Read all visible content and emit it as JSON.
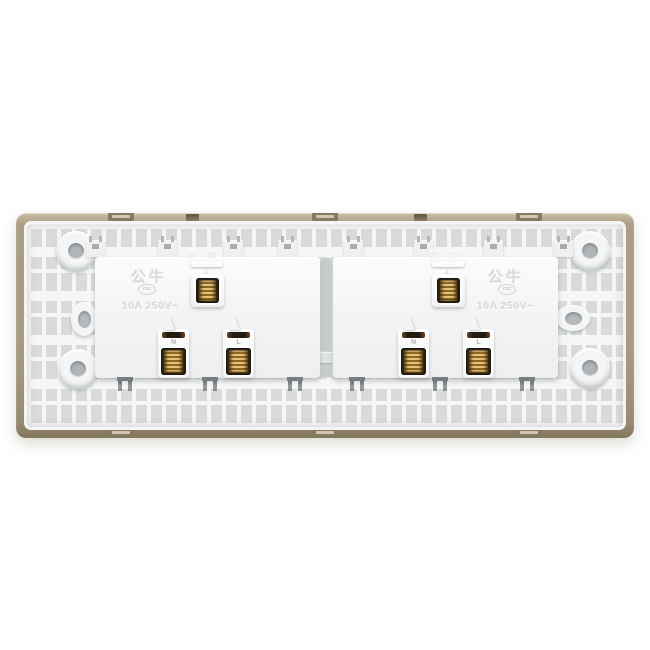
{
  "image": {
    "type": "product-photo",
    "subject": "Rear view of a dual-gang wall socket back plate",
    "background_color": "#ffffff"
  },
  "product": {
    "brand": "公牛",
    "certification_mark": "ccc",
    "rating": "10A 250V~",
    "frame_color": "#a89b82",
    "panel_color": "#f5f6f6",
    "lattice_cell_color": "#d8dadb",
    "brass_color": "#c59e52",
    "modules": [
      {
        "name": "left-socket-module",
        "brand": "公牛",
        "rating": "10A 250V~",
        "terminals": [
          {
            "type": "earth",
            "label": "⏚"
          },
          {
            "type": "neutral",
            "label": "N"
          },
          {
            "type": "live",
            "label": "L"
          }
        ]
      },
      {
        "name": "right-socket-module",
        "brand": "公牛",
        "rating": "10A 250V~",
        "terminals": [
          {
            "type": "earth",
            "label": "⏚"
          },
          {
            "type": "neutral",
            "label": "N"
          },
          {
            "type": "live",
            "label": "L"
          }
        ]
      }
    ]
  }
}
